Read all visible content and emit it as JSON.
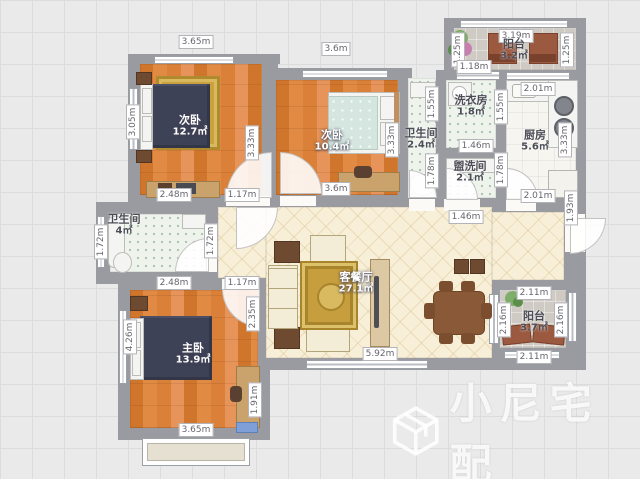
{
  "canvas": {
    "width": 640,
    "height": 479
  },
  "watermark": {
    "text": "小尼宅配",
    "logo": "cube-outline-icon"
  },
  "room_labels": [
    {
      "id": "bedroom-2",
      "name": "次卧",
      "area": "12.7㎡",
      "x": 190,
      "y": 126,
      "theme": "light"
    },
    {
      "id": "bedroom-3",
      "name": "次卧",
      "area": "10.4㎡",
      "x": 332,
      "y": 141,
      "theme": "light"
    },
    {
      "id": "bathroom-middle",
      "name": "卫生间",
      "area": "2.4㎡",
      "x": 421,
      "y": 139,
      "theme": "dark"
    },
    {
      "id": "laundry-room",
      "name": "洗衣房",
      "area": "1.8㎡",
      "x": 471,
      "y": 106,
      "theme": "dark"
    },
    {
      "id": "washroom",
      "name": "盥洗间",
      "area": "2.1㎡",
      "x": 470,
      "y": 172,
      "theme": "dark"
    },
    {
      "id": "kitchen",
      "name": "厨房",
      "area": "5.6㎡",
      "x": 535,
      "y": 141,
      "theme": "dark"
    },
    {
      "id": "balcony-top",
      "name": "阳台",
      "area": "3.2㎡",
      "x": 514,
      "y": 50,
      "theme": "dark"
    },
    {
      "id": "bathroom-left",
      "name": "卫生间",
      "area": "4㎡",
      "x": 124,
      "y": 225,
      "theme": "dark"
    },
    {
      "id": "master-bedroom",
      "name": "主卧",
      "area": "13.9㎡",
      "x": 193,
      "y": 354,
      "theme": "light"
    },
    {
      "id": "living-dining",
      "name": "客餐厅",
      "area": "27.1㎡",
      "x": 356,
      "y": 283,
      "theme": "light"
    },
    {
      "id": "balcony-right",
      "name": "阳台",
      "area": "3.7㎡",
      "x": 534,
      "y": 322,
      "theme": "dark"
    }
  ],
  "dimension_labels": [
    {
      "text": "3.65m",
      "x": 196,
      "y": 42,
      "vertical": false
    },
    {
      "text": "3.6m",
      "x": 336,
      "y": 49,
      "vertical": false
    },
    {
      "text": "3.19m",
      "x": 516,
      "y": 36,
      "vertical": false
    },
    {
      "text": "1.25m",
      "x": 458,
      "y": 50,
      "vertical": true
    },
    {
      "text": "1.25m",
      "x": 567,
      "y": 50,
      "vertical": true
    },
    {
      "text": "1.18m",
      "x": 474,
      "y": 67,
      "vertical": false
    },
    {
      "text": "2.01m",
      "x": 538,
      "y": 89,
      "vertical": false
    },
    {
      "text": "1.55m",
      "x": 432,
      "y": 104,
      "vertical": true
    },
    {
      "text": "1.55m",
      "x": 501,
      "y": 107,
      "vertical": true
    },
    {
      "text": "3.33m",
      "x": 565,
      "y": 140,
      "vertical": true
    },
    {
      "text": "1.78m",
      "x": 432,
      "y": 171,
      "vertical": true
    },
    {
      "text": "1.78m",
      "x": 501,
      "y": 170,
      "vertical": true
    },
    {
      "text": "1.46m",
      "x": 476,
      "y": 146,
      "vertical": false
    },
    {
      "text": "3.05m",
      "x": 133,
      "y": 122,
      "vertical": true
    },
    {
      "text": "3.33m",
      "x": 252,
      "y": 143,
      "vertical": true
    },
    {
      "text": "3.33m",
      "x": 392,
      "y": 140,
      "vertical": true
    },
    {
      "text": "2.48m",
      "x": 174,
      "y": 195,
      "vertical": false
    },
    {
      "text": "1.17m",
      "x": 242,
      "y": 195,
      "vertical": false
    },
    {
      "text": "3.6m",
      "x": 336,
      "y": 189,
      "vertical": false
    },
    {
      "text": "1.46m",
      "x": 466,
      "y": 217,
      "vertical": false
    },
    {
      "text": "2.01m",
      "x": 538,
      "y": 196,
      "vertical": false
    },
    {
      "text": "1.93m",
      "x": 571,
      "y": 208,
      "vertical": true
    },
    {
      "text": "1.72m",
      "x": 101,
      "y": 242,
      "vertical": true
    },
    {
      "text": "1.72m",
      "x": 211,
      "y": 241,
      "vertical": true
    },
    {
      "text": "2.48m",
      "x": 174,
      "y": 283,
      "vertical": false
    },
    {
      "text": "1.17m",
      "x": 242,
      "y": 283,
      "vertical": false
    },
    {
      "text": "4.26m",
      "x": 130,
      "y": 337,
      "vertical": true
    },
    {
      "text": "2.35m",
      "x": 253,
      "y": 314,
      "vertical": true
    },
    {
      "text": "1.91m",
      "x": 255,
      "y": 400,
      "vertical": true
    },
    {
      "text": "3.65m",
      "x": 196,
      "y": 430,
      "vertical": false
    },
    {
      "text": "5.92m",
      "x": 380,
      "y": 354,
      "vertical": false
    },
    {
      "text": "2.11m",
      "x": 534,
      "y": 293,
      "vertical": false
    },
    {
      "text": "2.16m",
      "x": 504,
      "y": 320,
      "vertical": true
    },
    {
      "text": "2.16m",
      "x": 561,
      "y": 320,
      "vertical": true
    },
    {
      "text": "2.11m",
      "x": 534,
      "y": 357,
      "vertical": false
    }
  ]
}
